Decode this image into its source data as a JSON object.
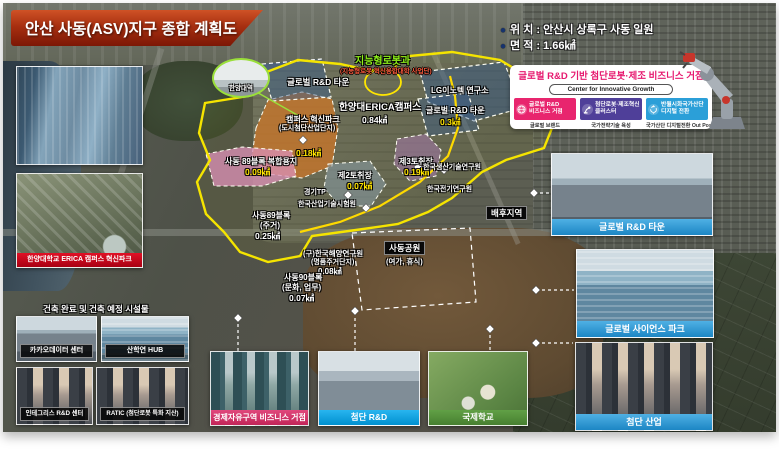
{
  "title": "안산 사동(ASV)지구 종합 계획도",
  "meta": {
    "location": "위 치 : 안산시 상록구 사동 일원",
    "area": "면 적 : 1.66㎢",
    "bullet": "●"
  },
  "info_box": {
    "title": "글로벌 R&D 기반 첨단로봇·제조 비즈니스 거점",
    "subtitle": "Center for Innovative Growth",
    "cards": [
      {
        "line1": "글로벌 R&D",
        "line2": "비즈니스 거점",
        "caption": "글로벌 브랜드",
        "color": "#e8256e",
        "icon": "globe-icon"
      },
      {
        "line1": "첨단로봇·제조혁신",
        "line2": "클러스터",
        "caption": "국가전략기술 육성",
        "color": "#4f3f99",
        "icon": "robot-arm-icon"
      },
      {
        "line1": "반월시화국가산단",
        "line2": "디지털 전환",
        "caption": "국가산단 디지털전환 Out Post",
        "color": "#2b9fd8",
        "icon": "digital-transform-icon"
      }
    ]
  },
  "map_labels": {
    "robot_dept": "지능형로봇과",
    "robot_dept_sub": "(지능형로봇 혁신융합대학 사업단)",
    "rnd_town_left": "글로벌 R&D 타운",
    "lg_innotek": "LG이노텍 연구소",
    "campus": "한양대ERICA캠퍼스",
    "campus_area": "0.84㎢",
    "innovation_park1": "캠퍼스 혁신파크",
    "innovation_park2": "(도시첨단산업단지)",
    "innovation_park_area": "0.18㎢",
    "rnd_town_right": "글로벌 R&D 타운",
    "rnd_town_right_area": "0.3㎢",
    "block89_mixed": "사동 89블록 복합용지",
    "block89_mixed_area": "0.09㎢",
    "block89_1": "사동89블록",
    "block89_2": "(주거)",
    "block89_area": "0.25㎢",
    "quarry2": "제2토취장",
    "quarry2_area": "0.07㎢",
    "quarry3": "제3토취장",
    "quarry3_area": "0.19㎢",
    "gtp": "경기TP",
    "kitl": "한국산업기술시험원",
    "kitech": "한국생산기술연구원",
    "keri": "한국전기연구원",
    "hinterland": "배후지역",
    "kordi1": "(구)한국해양연구원",
    "kordi2": "(명품주거단지)",
    "kordi_area": "0.08㎢",
    "block90_1": "사동90블록",
    "block90_2": "(문화, 업무)",
    "block90_area": "0.07㎢",
    "park_title": "사동공원",
    "park_sub": "(여가, 휴식)",
    "station": "한양대역"
  },
  "left_panel": {
    "erica_caption": "한양대학교 ERICA 캠퍼스 혁신파크",
    "facilities_header": "건축 완료 및 건축 예정 시설물",
    "grid": [
      "카카오데이터 센터",
      "산학연 HUB",
      "인테그리스 R&D 센터",
      "RATIC (첨단로봇 특화 지산)"
    ]
  },
  "bottom_panels": [
    "경제자유구역 비즈니스 거점",
    "첨단 R&D",
    "국제학교"
  ],
  "right_panels": [
    "글로벌 R&D 타운",
    "글로벌 사이언스 파크",
    "첨단 산업"
  ],
  "colors": {
    "banner_red": "#a72f10",
    "info_title_pink": "#e6186e",
    "card_pink": "#e8256e",
    "card_purple": "#4f3f99",
    "card_blue": "#2b9fd8",
    "boundary_yellow": "#ffe600",
    "caption_pink": "#c22558",
    "caption_cyan": "#0090cf",
    "caption_green": "#477f30",
    "caption_blue": "#1c86c4",
    "erica_caption_red": "#c40018"
  }
}
